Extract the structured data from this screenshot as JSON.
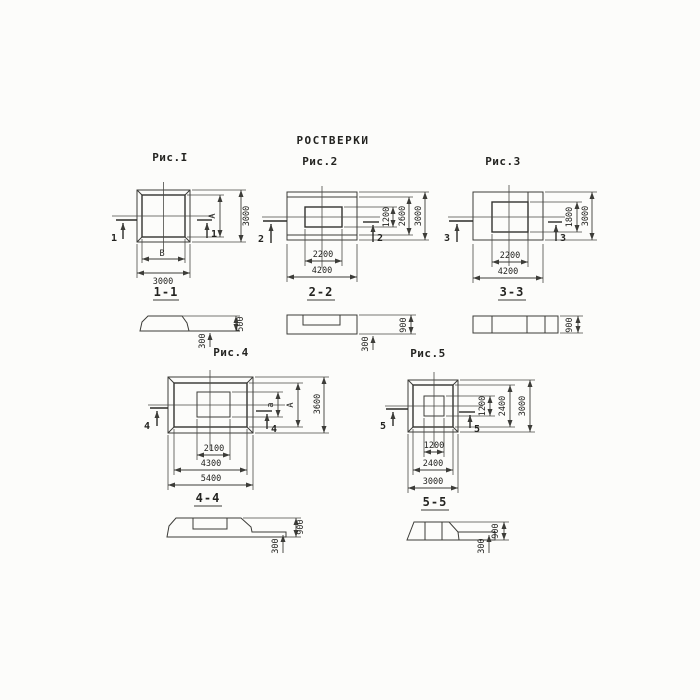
{
  "title": "РОСТВЕРКИ",
  "fig1": {
    "label": "Рис.I",
    "cut": "1",
    "section_label": "1-1",
    "dim_height": "3000",
    "dim_inner_height": "А",
    "dim_width": "3000",
    "dim_inner_width": "В",
    "sec_height": "500",
    "sec_toe": "300"
  },
  "fig2": {
    "label": "Рис.2",
    "cut": "2",
    "section_label": "2-2",
    "dim_inner_height": "1200",
    "dim_mid_height": "2600",
    "dim_height": "3000",
    "dim_inner_width": "2200",
    "dim_width": "4200",
    "sec_height": "900",
    "sec_toe": "300"
  },
  "fig3": {
    "label": "Рис.3",
    "cut": "3",
    "section_label": "3-3",
    "dim_inner_height": "1800",
    "dim_height": "3000",
    "dim_inner_width": "2200",
    "dim_width": "4200",
    "sec_height": "900"
  },
  "fig4": {
    "label": "Рис.4",
    "cut": "4",
    "section_label": "4-4",
    "dim_inner_height": "а",
    "dim_mid_height": "А",
    "dim_height": "3600",
    "dim_inner_width": "2100",
    "dim_mid_width": "4300",
    "dim_width": "5400",
    "sec_height": "900",
    "sec_toe": "300"
  },
  "fig5": {
    "label": "Рис.5",
    "cut": "5",
    "section_label": "5-5",
    "dim_inner_height": "1200",
    "dim_mid_height": "2400",
    "dim_height": "3000",
    "dim_inner_width": "1200",
    "dim_mid_width": "2400",
    "dim_width": "3000",
    "sec_height": "900",
    "sec_toe": "300"
  }
}
